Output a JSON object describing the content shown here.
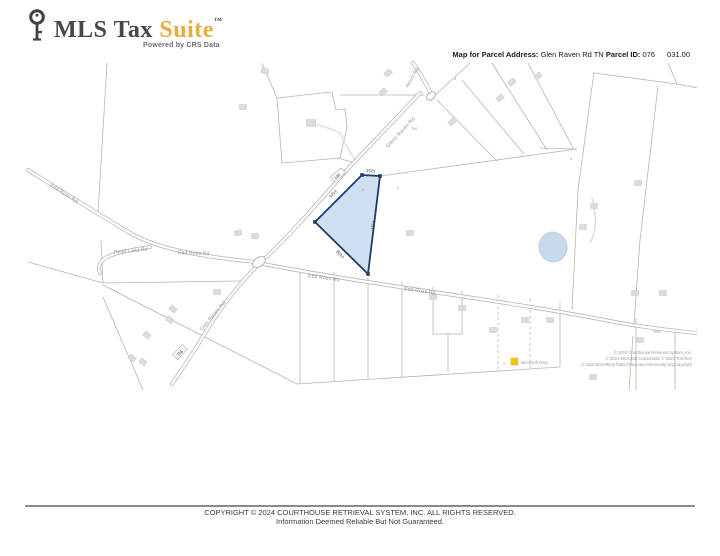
{
  "header": {
    "logo": {
      "brand_prefix": "MLS Tax ",
      "brand_accent": "Suite",
      "trademark": "™",
      "tagline": "Powered by CRS Data"
    },
    "map_info": {
      "address_label": "Map for Parcel Address:",
      "address_value": "Glen Raven Rd TN",
      "parcel_id_label": "Parcel ID:",
      "parcel_id_map": "076",
      "parcel_id_parcel": "031.00"
    }
  },
  "map": {
    "road_labels": {
      "edd_ross_west": "Edd Ross Rd",
      "pearl_lietz": "Pearl Lietz Rd",
      "edd_ross_mid": "Edd Ross Rd",
      "edd_ross_east1": "Edd Ross Rd",
      "edd_ross_east2": "Edd Ross Rd",
      "glenn_raven_upper": "Glenn Raven Rd",
      "glen_raven_lower": "Glen Raven Rd",
      "hinch": "Hinch Rd"
    },
    "subject_parcel": {
      "dim_top": "152±",
      "dim_left": "521±",
      "dim_right": "151±",
      "dim_bottom": "801±",
      "lot": "1",
      "frontage_marker": "140"
    },
    "route_marker": "756",
    "lot_numbers": {
      "a": "2",
      "b": "3",
      "c": "754",
      "d": "4"
    },
    "attribution": {
      "bing": "Microsoft Bing",
      "line1": "© 2024 Courthouse Retrieval System, Inc.",
      "line2": "© 2024 Microsoft Corporation © 2024 TomTom",
      "line3": "© OpenStreetMap https://www.openstreetmap.org/copyright"
    }
  },
  "footer": {
    "line1": "COPYRIGHT © 2024 COURTHOUSE RETRIEVAL SYSTEM, INC. ALL RIGHTS RESERVED.",
    "line2": "Information Deemed Reliable But Not Guaranteed."
  },
  "colors": {
    "accent_gold": "#E8AC3C",
    "parcel_fill": "#CBDCF0",
    "parcel_stroke": "#1C3A6E",
    "map_line": "#A5B29B",
    "road_casing": "#B9B9B1",
    "water_fill": "#C7D9EC"
  }
}
